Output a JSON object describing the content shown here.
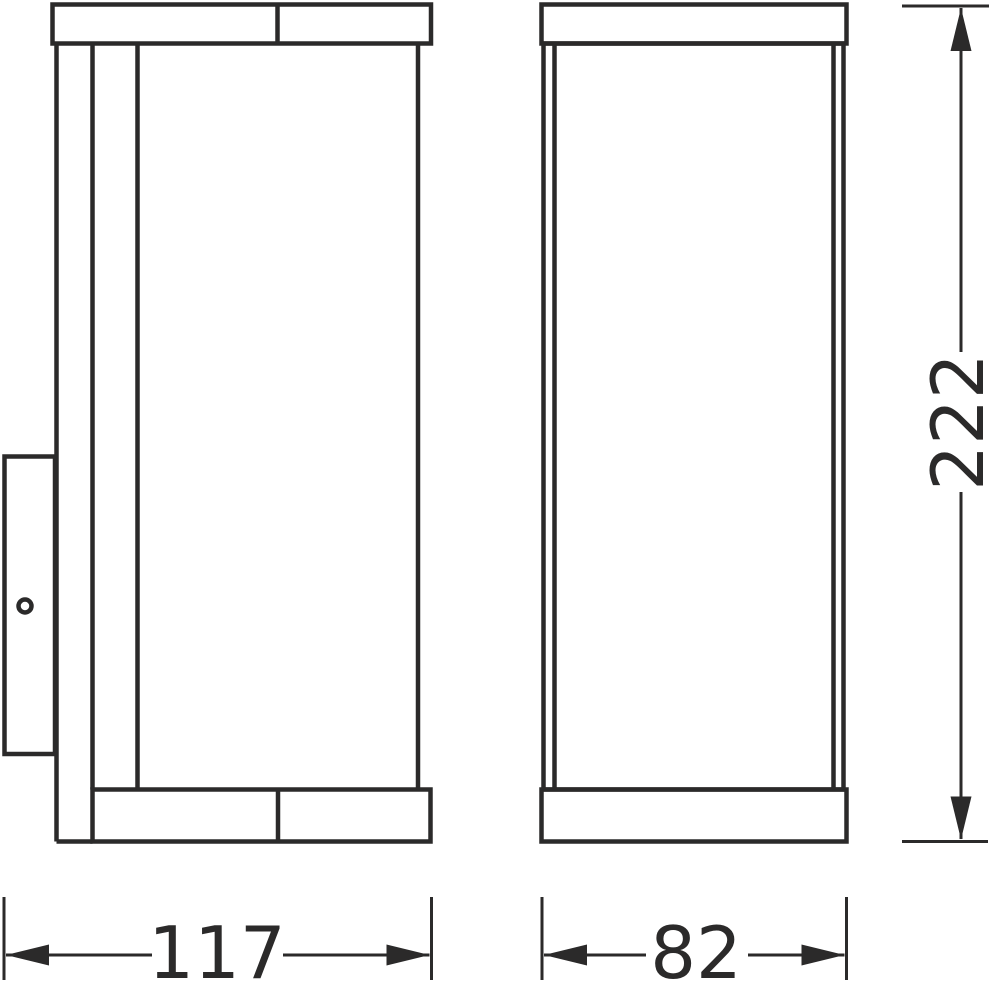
{
  "drawing": {
    "background": "#ffffff",
    "line_color": "#2b2a2a",
    "views": {
      "side_view": {
        "id": "side-view"
      },
      "front_view": {
        "id": "front-view"
      }
    },
    "dimensions": {
      "side_width": {
        "label": "117",
        "orientation": "horizontal"
      },
      "front_width": {
        "label": "82",
        "orientation": "horizontal"
      },
      "overall_height": {
        "label": "222",
        "orientation": "vertical"
      }
    }
  }
}
